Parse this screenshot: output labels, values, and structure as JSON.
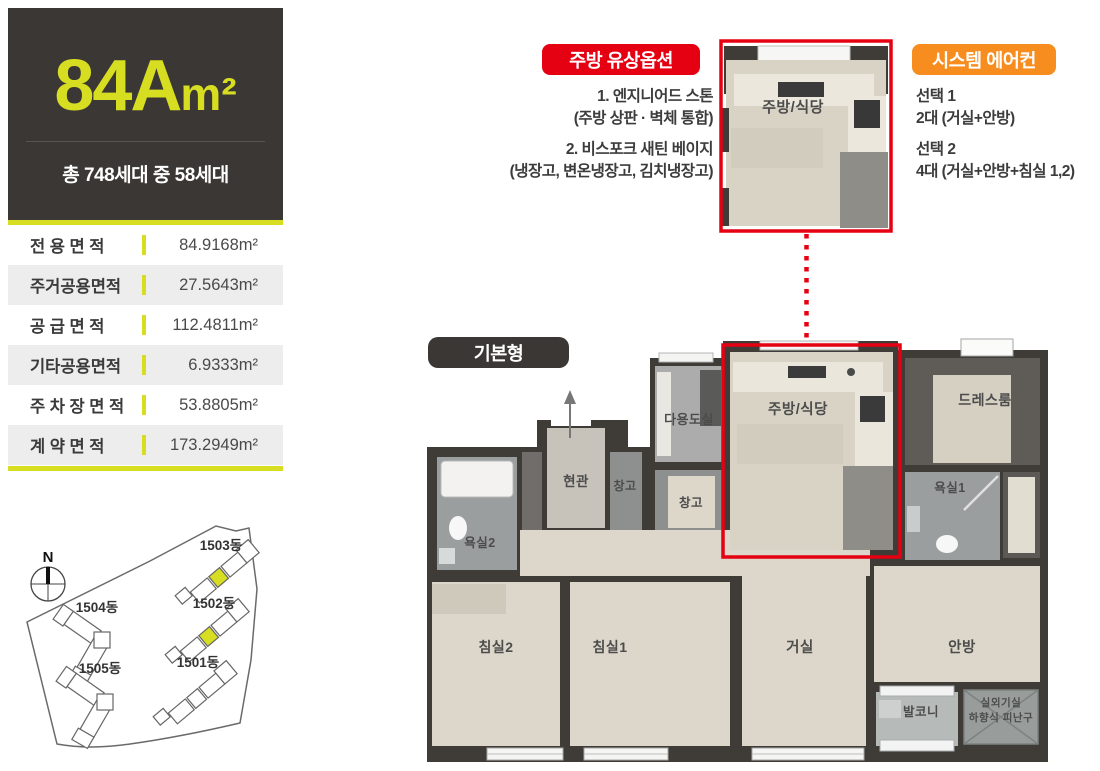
{
  "header": {
    "type_code": "84A",
    "type_unit": "m²",
    "household_info": "총 748세대 중 58세대"
  },
  "area_table": {
    "rows": [
      {
        "label": "전 용 면 적",
        "value": "84.9168m²"
      },
      {
        "label": "주거공용면적",
        "value": "27.5643m²"
      },
      {
        "label": "공 급 면 적",
        "value": "112.4811m²"
      },
      {
        "label": "기타공용면적",
        "value": "6.9333m²"
      },
      {
        "label": "주 차 장 면 적",
        "value": "53.8805m²"
      },
      {
        "label": "계 약 면 적",
        "value": "173.2949m²"
      }
    ]
  },
  "options": {
    "kitchen": {
      "title": "주방 유상옵션",
      "lines": [
        "1. 엔지니어드 스톤",
        "(주방 상판 · 벽체 통합)",
        "2. 비스포크 새틴 베이지",
        "(냉장고, 변온냉장고, 김치냉장고)"
      ]
    },
    "aircon": {
      "title": "시스템 에어컨",
      "lines": [
        "선택 1",
        "2대 (거실+안방)",
        "선택 2",
        "4대 (거실+안방+침실 1,2)"
      ]
    }
  },
  "floor_plan": {
    "type_label": "기본형",
    "rooms": {
      "kitchen": "주방/식당",
      "utility": "다용도실",
      "entrance": "현관",
      "storage_a": "창고",
      "storage_b": "창고",
      "bath2": "욕실2",
      "bath1": "욕실1",
      "dress": "드레스룸",
      "bed2": "침실2",
      "bed1": "침실1",
      "living": "거실",
      "master": "안방",
      "balcony": "발코니",
      "outdoor_unit": "실외기실",
      "escape_hatch": "하향식 피난구"
    }
  },
  "site_plan": {
    "north_label": "N",
    "buildings": [
      {
        "label": "1503동",
        "highlighted": true
      },
      {
        "label": "1504동",
        "highlighted": false
      },
      {
        "label": "1502동",
        "highlighted": true
      },
      {
        "label": "1505동",
        "highlighted": false
      },
      {
        "label": "1501동",
        "highlighted": false
      }
    ]
  },
  "colors": {
    "accent_yellow": "#d7de21",
    "option_red": "#e50012",
    "option_orange": "#f68d1e",
    "panel_dark": "#3a3734",
    "wall_dark": "#3f3b37",
    "floor_beige": "#ddd7cb"
  }
}
